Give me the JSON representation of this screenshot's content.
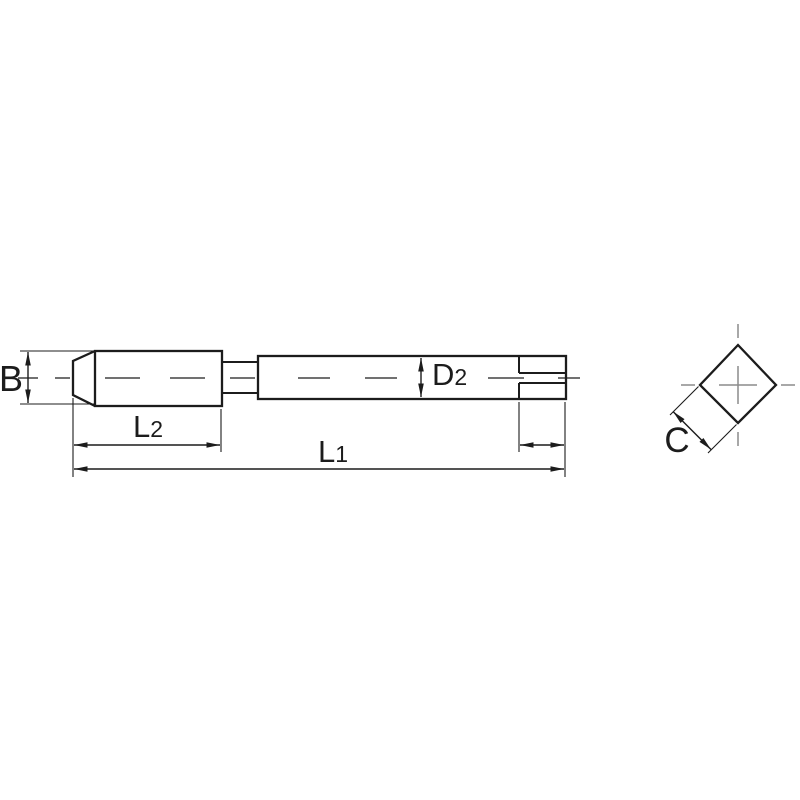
{
  "drawing": {
    "kind": "dimensioned technical line drawing, side view of a tap-style shank tool plus square-end section view"
  },
  "colors": {
    "background": "#ffffff",
    "outline": "#1c1c1c",
    "dimension": "#1c1c1c",
    "centerline_main": "#2e2e2e",
    "centerline_section": "#8c8c8c"
  },
  "labels": {
    "b": {
      "main": "B",
      "sub": ""
    },
    "l2": {
      "main": "L",
      "sub": "2"
    },
    "l1": {
      "main": "L",
      "sub": "1"
    },
    "d2": {
      "main": "D",
      "sub": "2"
    },
    "c": {
      "main": "C",
      "sub": ""
    }
  },
  "annotations": [
    {
      "id": "b",
      "text": "B",
      "placement": "left of tip, vertical double-arrow dimension"
    },
    {
      "id": "l2",
      "text": "L2",
      "placement": "below thread section, horizontal dimension"
    },
    {
      "id": "l1",
      "text": "L1",
      "placement": "below full part, overall-length dimension"
    },
    {
      "id": "d2",
      "text": "D2",
      "placement": "inside shank, vertical diameter dimension"
    },
    {
      "id": "square_length",
      "text": "",
      "placement": "below square drive end, unlabeled horizontal dimension"
    },
    {
      "id": "c",
      "text": "C",
      "placement": "lower-left of square section view, diagonal dimension"
    }
  ]
}
